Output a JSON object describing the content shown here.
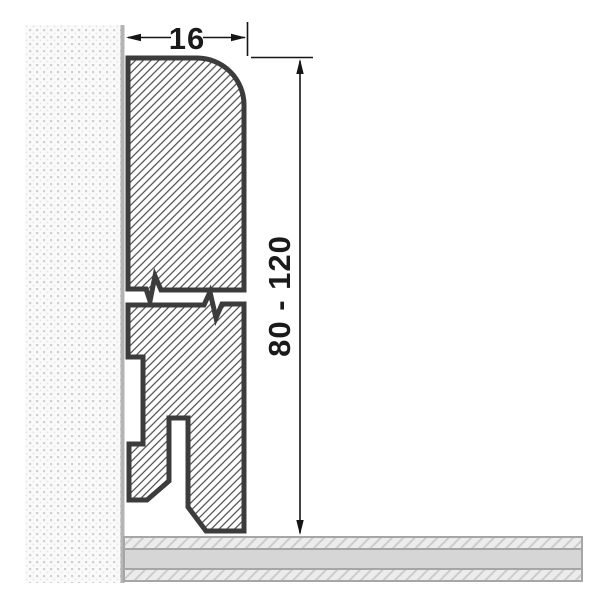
{
  "diagram": {
    "subject": "skirting-board-cross-section",
    "dimensions": {
      "width_label": "16",
      "height_label": "80 - 120"
    },
    "colors": {
      "background": "#ffffff",
      "profile_outline": "#3c3c3c",
      "hatch_line": "#4a4a4a",
      "dimension_line": "#151515",
      "wall_dot": "#d0d0d0",
      "wall_background": "#fafafa",
      "wall_edge_line": "#b4b4b4",
      "floor_solid_fill": "#d6d6d6",
      "floor_hatch_fill": "#ececec",
      "floor_border": "#a6a6a6"
    }
  }
}
